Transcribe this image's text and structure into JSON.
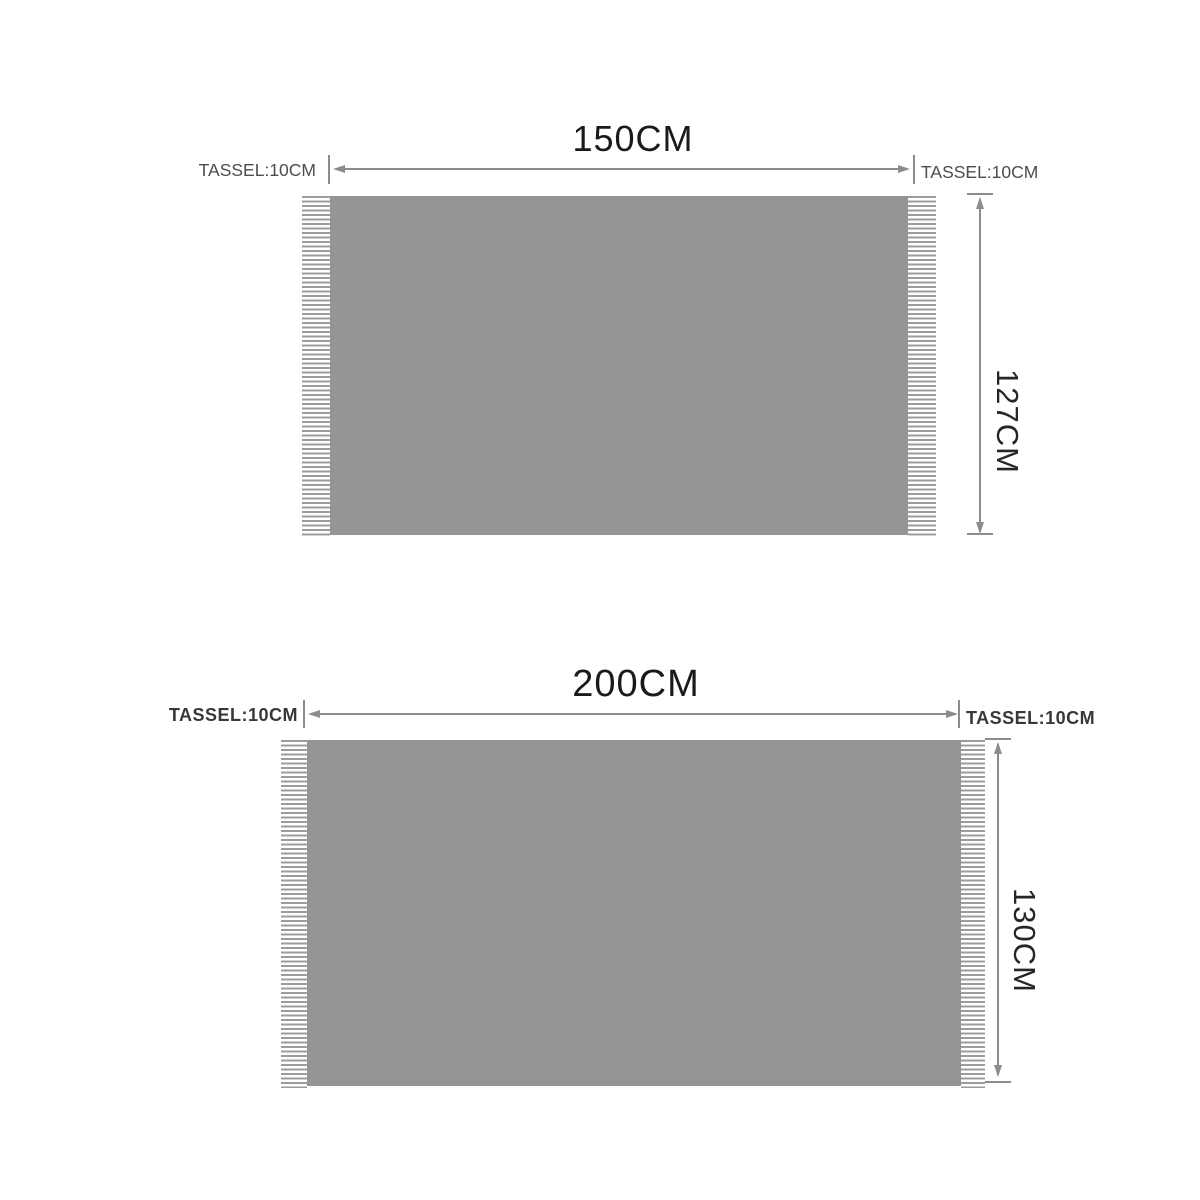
{
  "colors": {
    "fabric": "#959595",
    "fringe": "#9c9c9c",
    "dimension_line": "#8c8c8c",
    "title_text": "#1a1a1a",
    "tassel_text": "#4d4d4d",
    "tassel_text_bold": "#383838",
    "side_label_text": "#262626",
    "canvas_bg": "#ffffff"
  },
  "icons": {
    "arrowhead_left": "css-triangle-left",
    "arrowhead_right": "css-triangle-right",
    "arrowhead_up": "css-triangle-up",
    "arrowhead_down": "css-triangle-down"
  },
  "diagrams": [
    {
      "width_label": "150CM",
      "height_label": "127CM",
      "tassel_left_label": "TASSEL:10CM",
      "tassel_right_label": "TASSEL:10CM"
    },
    {
      "width_label": "200CM",
      "height_label": "130CM",
      "tassel_left_label": "TASSEL:10CM",
      "tassel_right_label": "TASSEL:10CM"
    }
  ]
}
